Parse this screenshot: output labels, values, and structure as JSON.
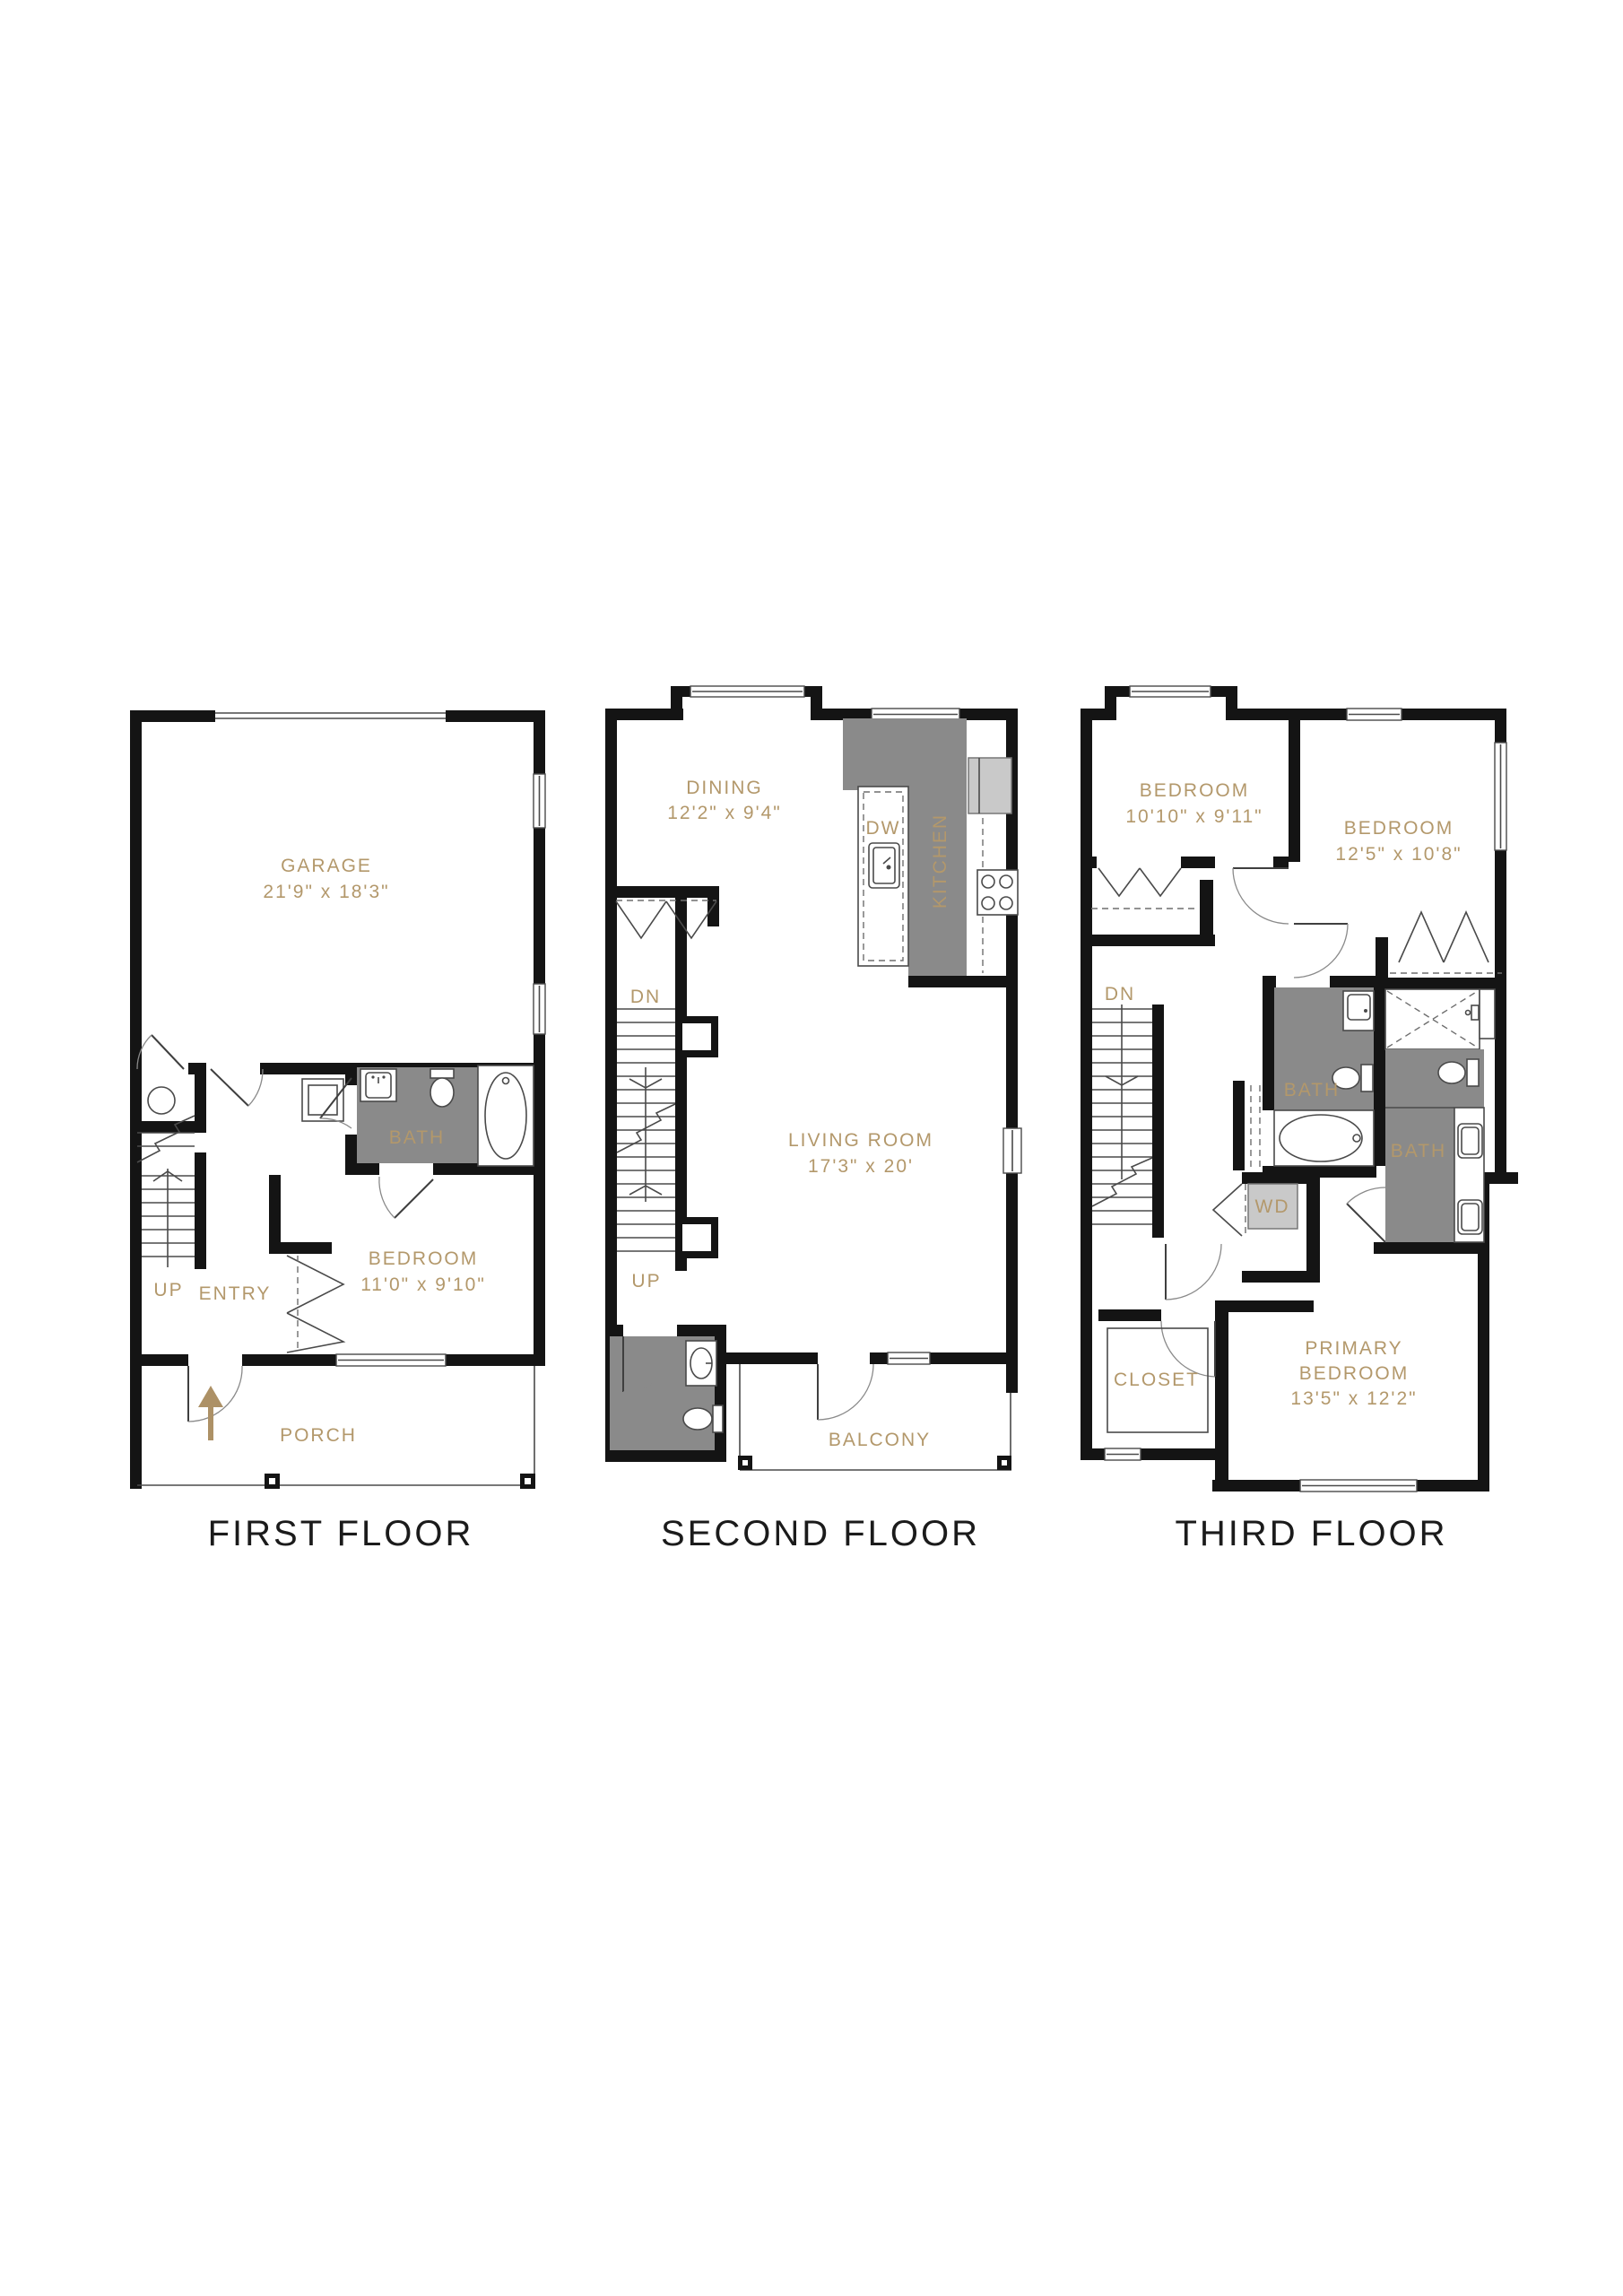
{
  "figure": "Three-story townhome floor plan",
  "colors": {
    "label": "#b3986b",
    "wall": "#141414",
    "wet_area": "#8a8a8a",
    "arrow": "#ad9166"
  },
  "floor1": {
    "title": "FIRST FLOOR",
    "garage": {
      "name": "GARAGE",
      "dims": "21'9\" x 18'3\""
    },
    "bath": {
      "name": "BATH"
    },
    "bedroom": {
      "name": "BEDROOM",
      "dims": "11'0\" x 9'10\""
    },
    "entry": {
      "name": "ENTRY"
    },
    "porch": {
      "name": "PORCH"
    },
    "stairs_up": {
      "name": "UP"
    }
  },
  "floor2": {
    "title": "SECOND FLOOR",
    "dining": {
      "name": "DINING",
      "dims": "12'2\" x 9'4\""
    },
    "kitchen": {
      "name": "KITCHEN"
    },
    "dishwasher": {
      "name": "DW"
    },
    "living": {
      "name": "LIVING ROOM",
      "dims": "17'3\" x 20'"
    },
    "balcony": {
      "name": "BALCONY"
    },
    "stairs_down": {
      "name": "DN"
    },
    "stairs_up": {
      "name": "UP"
    }
  },
  "floor3": {
    "title": "THIRD FLOOR",
    "bedroom_a": {
      "name": "BEDROOM",
      "dims": "10'10\" x 9'11\""
    },
    "bedroom_b": {
      "name": "BEDROOM",
      "dims": "12'5\" x 10'8\""
    },
    "bath_a": {
      "name": "BATH"
    },
    "bath_b": {
      "name": "BATH"
    },
    "washer_dryer": {
      "name": "WD"
    },
    "closet": {
      "name": "CLOSET"
    },
    "primary": {
      "name_line1": "PRIMARY",
      "name_line2": "BEDROOM",
      "dims": "13'5\" x 12'2\""
    },
    "stairs_down": {
      "name": "DN"
    }
  }
}
